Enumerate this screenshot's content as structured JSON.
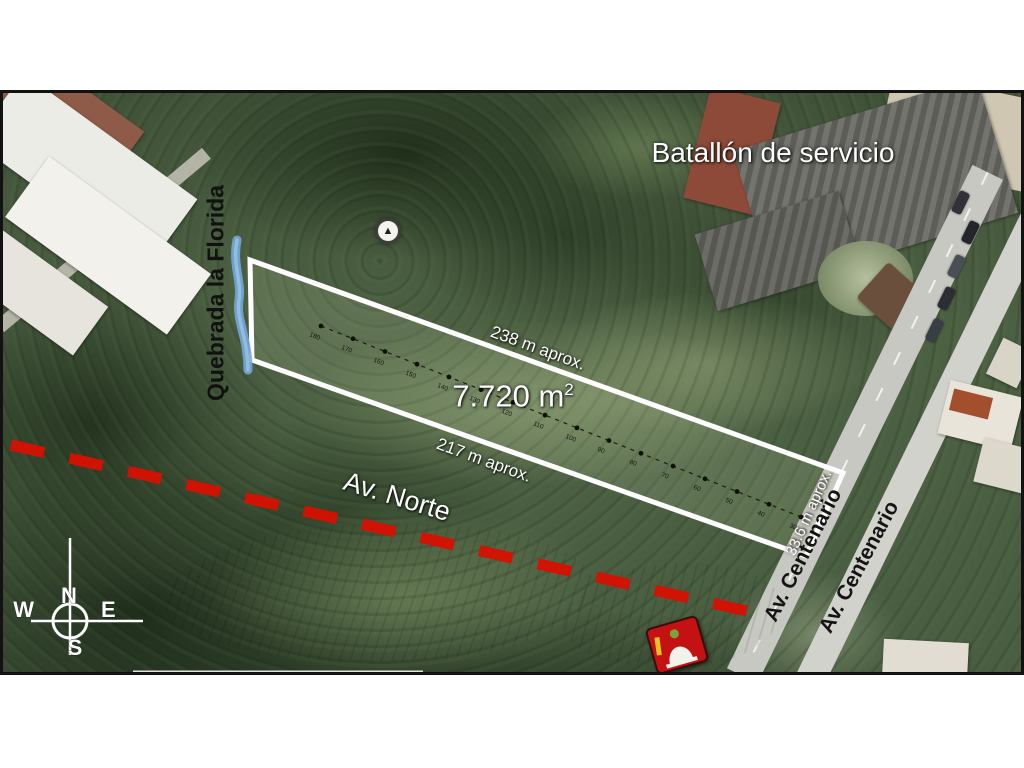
{
  "map": {
    "type": "annotated-satellite-parcel-plan",
    "labels": {
      "building_top_right": "Batallón de servicio",
      "stream": "Quebrada la Florida",
      "parcel_area": {
        "value": "7.720 m",
        "superscript": "2"
      },
      "edge_top_length": "238 m  aprox.",
      "edge_bottom_length": "217 m  aprox.",
      "edge_right_length": "33.6 m  aprox.",
      "dashed_road": "Av. Norte",
      "main_road_1": "Av. Centenario",
      "main_road_2": "Av. Centenario"
    },
    "compass": {
      "north": "N",
      "east": "E",
      "south": "S",
      "west": "W"
    },
    "measure_line_ticks": [
      "180",
      "170",
      "160",
      "150",
      "140",
      "130",
      "120",
      "110",
      "100",
      "90",
      "80",
      "70",
      "60",
      "50",
      "40",
      "30"
    ],
    "colors": {
      "parcel_outline": "#ffffff",
      "stream": "#74a9d8",
      "dashed_road": "#d81000",
      "light_label": "#ffffff",
      "dark_label": "#141414",
      "sign_red": "#c41111"
    }
  }
}
